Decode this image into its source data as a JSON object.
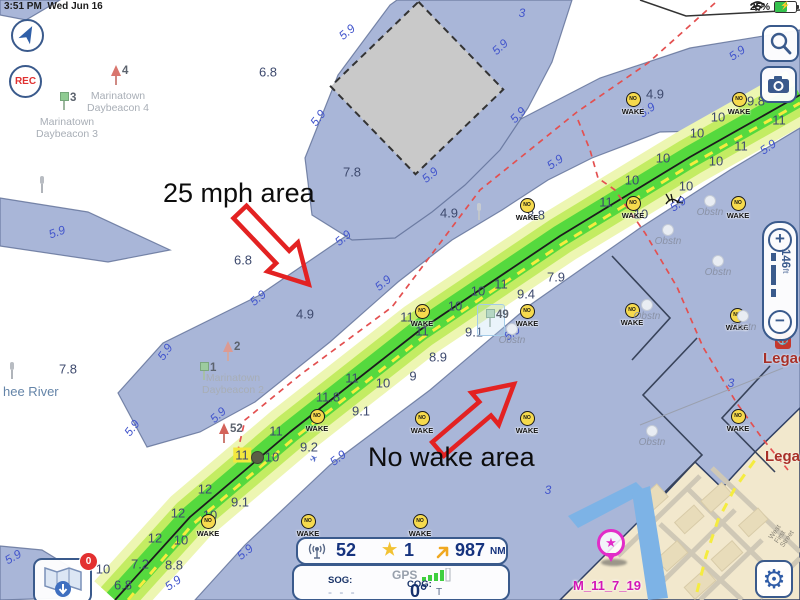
{
  "status_bar": {
    "time": "3:51 PM",
    "date": "Wed Jun 16",
    "battery_percent": "25%"
  },
  "map_controls": {
    "rec_label": "REC",
    "scale_value": "146",
    "scale_unit": "ft"
  },
  "annotations": {
    "speed_area": "25 mph area",
    "no_wake_area": "No wake area"
  },
  "instrument_bar": {
    "track_count": "52",
    "star_count": "1",
    "distance": "987",
    "distance_unit": "NM"
  },
  "nav_panel": {
    "sog_label": "SOG:",
    "sog_value": "- - -",
    "gps_label": "GPS",
    "cog_label": "COG:",
    "cog_value": "0°",
    "cog_unit": "T"
  },
  "waypoint": {
    "label": "M_11_7_19"
  },
  "place_labels": {
    "river": "hee River",
    "street": "West First Street",
    "legacy1": "Legacy H",
    "legacy2": "Legacy"
  },
  "download_badge": "0",
  "icons": {
    "star": "★",
    "bolt": "⚡",
    "gear": "⚙",
    "plane": "✈"
  },
  "markers": {
    "no_wake": {
      "top": "NO",
      "bottom": "WAKE"
    },
    "obstruction": "Obstn"
  },
  "marina_icon_label": "⚓",
  "soundings": [
    {
      "v": "6.8",
      "x": 268,
      "y": 72
    },
    {
      "v": "7.8",
      "x": 352,
      "y": 172
    },
    {
      "v": "6.8",
      "x": 243,
      "y": 260
    },
    {
      "v": "4.9",
      "x": 655,
      "y": 94
    },
    {
      "v": "4.9",
      "x": 449,
      "y": 213
    },
    {
      "v": "4.9",
      "x": 305,
      "y": 314
    },
    {
      "v": "9.8",
      "x": 756,
      "y": 101
    },
    {
      "v": "7.8",
      "x": 68,
      "y": 369
    },
    {
      "v": "10",
      "x": 718,
      "y": 117
    },
    {
      "v": "11",
      "x": 779,
      "y": 120
    },
    {
      "v": "10",
      "x": 697,
      "y": 133
    },
    {
      "v": "11",
      "x": 741,
      "y": 146
    },
    {
      "v": "10",
      "x": 663,
      "y": 158
    },
    {
      "v": "10",
      "x": 716,
      "y": 161
    },
    {
      "v": "10",
      "x": 632,
      "y": 180
    },
    {
      "v": "10",
      "x": 686,
      "y": 186
    },
    {
      "v": "11",
      "x": 606,
      "y": 202
    },
    {
      "v": "10",
      "x": 641,
      "y": 214
    },
    {
      "v": "8.8",
      "x": 536,
      "y": 215
    },
    {
      "v": "7.9",
      "x": 556,
      "y": 277
    },
    {
      "v": "11",
      "x": 501,
      "y": 284
    },
    {
      "v": "10",
      "x": 478,
      "y": 291
    },
    {
      "v": "9.4",
      "x": 526,
      "y": 294
    },
    {
      "v": "10",
      "x": 455,
      "y": 306
    },
    {
      "v": "11",
      "x": 407,
      "y": 317
    },
    {
      "v": "11",
      "x": 422,
      "y": 331
    },
    {
      "v": "9.1",
      "x": 474,
      "y": 332
    },
    {
      "v": "8.9",
      "x": 438,
      "y": 357
    },
    {
      "v": "9",
      "x": 413,
      "y": 376
    },
    {
      "v": "11",
      "x": 352,
      "y": 378
    },
    {
      "v": "10",
      "x": 383,
      "y": 383
    },
    {
      "v": "11.8",
      "x": 328,
      "y": 397
    },
    {
      "v": "9.1",
      "x": 361,
      "y": 411
    },
    {
      "v": "11",
      "x": 276,
      "y": 431
    },
    {
      "v": "9.2",
      "x": 309,
      "y": 447
    },
    {
      "v": "10",
      "x": 272,
      "y": 457
    },
    {
      "v": "11",
      "x": 242,
      "y": 455,
      "hl": true
    },
    {
      "v": "12",
      "x": 205,
      "y": 489
    },
    {
      "v": "9.1",
      "x": 240,
      "y": 502
    },
    {
      "v": "12",
      "x": 178,
      "y": 513
    },
    {
      "v": "10",
      "x": 210,
      "y": 515
    },
    {
      "v": "12",
      "x": 155,
      "y": 538
    },
    {
      "v": "10",
      "x": 181,
      "y": 540
    },
    {
      "v": "10",
      "x": 103,
      "y": 569
    },
    {
      "v": "7.2",
      "x": 140,
      "y": 564
    },
    {
      "v": "8.8",
      "x": 174,
      "y": 565
    },
    {
      "v": "6.8",
      "x": 123,
      "y": 585
    }
  ],
  "contours": [
    {
      "v": "5.9",
      "x": 347,
      "y": 32,
      "r": -40
    },
    {
      "v": "5.9",
      "x": 500,
      "y": 47,
      "r": -42
    },
    {
      "v": "5.9",
      "x": 318,
      "y": 118,
      "r": -52
    },
    {
      "v": "5.9",
      "x": 518,
      "y": 115,
      "r": -45
    },
    {
      "v": "5.9",
      "x": 430,
      "y": 175,
      "r": -40
    },
    {
      "v": "5.9",
      "x": 737,
      "y": 53,
      "r": -35
    },
    {
      "v": "5.9",
      "x": 647,
      "y": 110,
      "r": -35
    },
    {
      "v": "5.9",
      "x": 555,
      "y": 162,
      "r": -35
    },
    {
      "v": "5.9",
      "x": 768,
      "y": 147,
      "r": -35
    },
    {
      "v": "5.9",
      "x": 678,
      "y": 204,
      "r": -35
    },
    {
      "v": "5.9",
      "x": 343,
      "y": 238,
      "r": -40
    },
    {
      "v": "5.9",
      "x": 383,
      "y": 283,
      "r": -40
    },
    {
      "v": "5.9",
      "x": 258,
      "y": 298,
      "r": -40
    },
    {
      "v": "5.9",
      "x": 512,
      "y": 333,
      "r": -35
    },
    {
      "v": "5.9",
      "x": 218,
      "y": 415,
      "r": -42
    },
    {
      "v": "5.9",
      "x": 338,
      "y": 458,
      "r": -38
    },
    {
      "v": "5.9",
      "x": 165,
      "y": 352,
      "r": -55
    },
    {
      "v": "5.9",
      "x": 132,
      "y": 428,
      "r": -52
    },
    {
      "v": "5.9",
      "x": 57,
      "y": 232,
      "r": -20
    },
    {
      "v": "5.9",
      "x": 13,
      "y": 557,
      "r": -30
    },
    {
      "v": "5.9",
      "x": 245,
      "y": 552,
      "r": -40
    },
    {
      "v": "5.9",
      "x": 173,
      "y": 583,
      "r": -35
    },
    {
      "v": "3",
      "x": 522,
      "y": 13,
      "r": 0
    },
    {
      "v": "3",
      "x": 731,
      "y": 383,
      "r": 0
    },
    {
      "v": "3",
      "x": 548,
      "y": 490,
      "r": 0
    }
  ],
  "no_wake_positions": [
    [
      633,
      100
    ],
    [
      739,
      100
    ],
    [
      527,
      206
    ],
    [
      633,
      204
    ],
    [
      738,
      204
    ],
    [
      632,
      311
    ],
    [
      737,
      316
    ],
    [
      738,
      417
    ],
    [
      422,
      312
    ],
    [
      527,
      312
    ],
    [
      422,
      419
    ],
    [
      527,
      419
    ],
    [
      317,
      417
    ],
    [
      208,
      522
    ],
    [
      308,
      522
    ],
    [
      420,
      522
    ]
  ],
  "obstruction_positions": [
    [
      710,
      202
    ],
    [
      668,
      231
    ],
    [
      718,
      262
    ],
    [
      647,
      306
    ],
    [
      743,
      317
    ],
    [
      652,
      432
    ],
    [
      512,
      330
    ]
  ],
  "beacons": [
    {
      "x": 64,
      "y": 92,
      "shape": "sq",
      "color": "#8fcb92",
      "pole": "#9fb8a0",
      "num": "3"
    },
    {
      "x": 116,
      "y": 65,
      "shape": "tri",
      "color": "#d9766e",
      "pole": "#cf8a84",
      "num": "4"
    },
    {
      "x": 204,
      "y": 362,
      "shape": "sq",
      "color": "#9ccb9e",
      "pole": "#a8bfa9",
      "num": "1"
    },
    {
      "x": 228,
      "y": 341,
      "shape": "tri",
      "color": "#dc9a92",
      "pole": "#d0a8a2",
      "num": "2"
    },
    {
      "x": 224,
      "y": 423,
      "shape": "tri",
      "color": "#d4635a",
      "pole": "#cc7d74",
      "num": "52"
    },
    {
      "x": 490,
      "y": 309,
      "shape": "sq",
      "color": "#b9d9b4",
      "pole": "#b8c4b8",
      "num": "49",
      "sel": true
    },
    {
      "x": 42,
      "y": 176,
      "shape": "post",
      "color": "#b8bcc2",
      "pole": "#b0b4ba",
      "num": ""
    },
    {
      "x": 12,
      "y": 362,
      "shape": "post",
      "color": "#b8bcc2",
      "pole": "#b0b4ba",
      "num": ""
    },
    {
      "x": 479,
      "y": 203,
      "shape": "post",
      "color": "#c6cbd1",
      "pole": "#c0c5cb",
      "num": ""
    }
  ],
  "beacon_labels": [
    {
      "x": 67,
      "y": 116,
      "text": "Marinatown\nDaybeacon 3"
    },
    {
      "x": 118,
      "y": 90,
      "text": "Marinatown\nDaybeacon 4"
    },
    {
      "x": 233,
      "y": 372,
      "text": "Marinatown\nDaybeacon 2"
    }
  ]
}
